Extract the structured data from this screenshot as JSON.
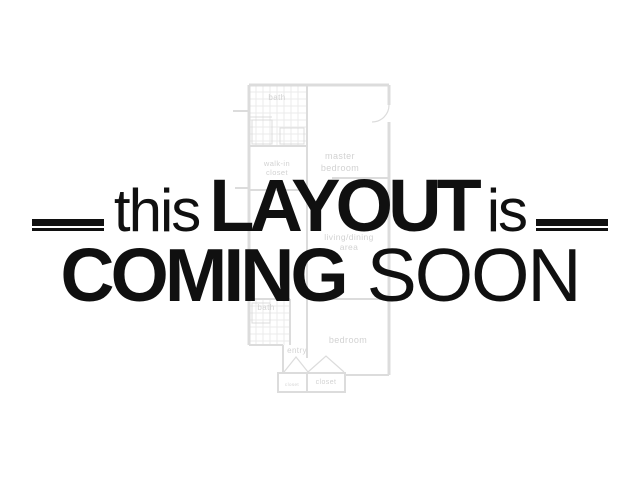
{
  "overlay": {
    "line1": {
      "left_word": "this",
      "emphasis": "LAYOUT",
      "right_word": "is"
    },
    "line2": {
      "emphasis": "COMING",
      "word": "SOON"
    },
    "text_color": "#101010"
  },
  "floorplan": {
    "line_color": "#dcdcdc",
    "grid_color": "#ebebeb",
    "label_color": "#d2d2d2",
    "labels": {
      "bath_upper": "bath",
      "walk_in_line1": "walk-in",
      "walk_in_line2": "closet",
      "master_line1": "master",
      "master_line2": "bedroom",
      "living_line1": "living/dining",
      "living_line2": "area",
      "bath_lower": "bath",
      "bedroom": "bedroom",
      "entry": "entry",
      "closet_small": "closet",
      "closet_large": "closet"
    }
  }
}
